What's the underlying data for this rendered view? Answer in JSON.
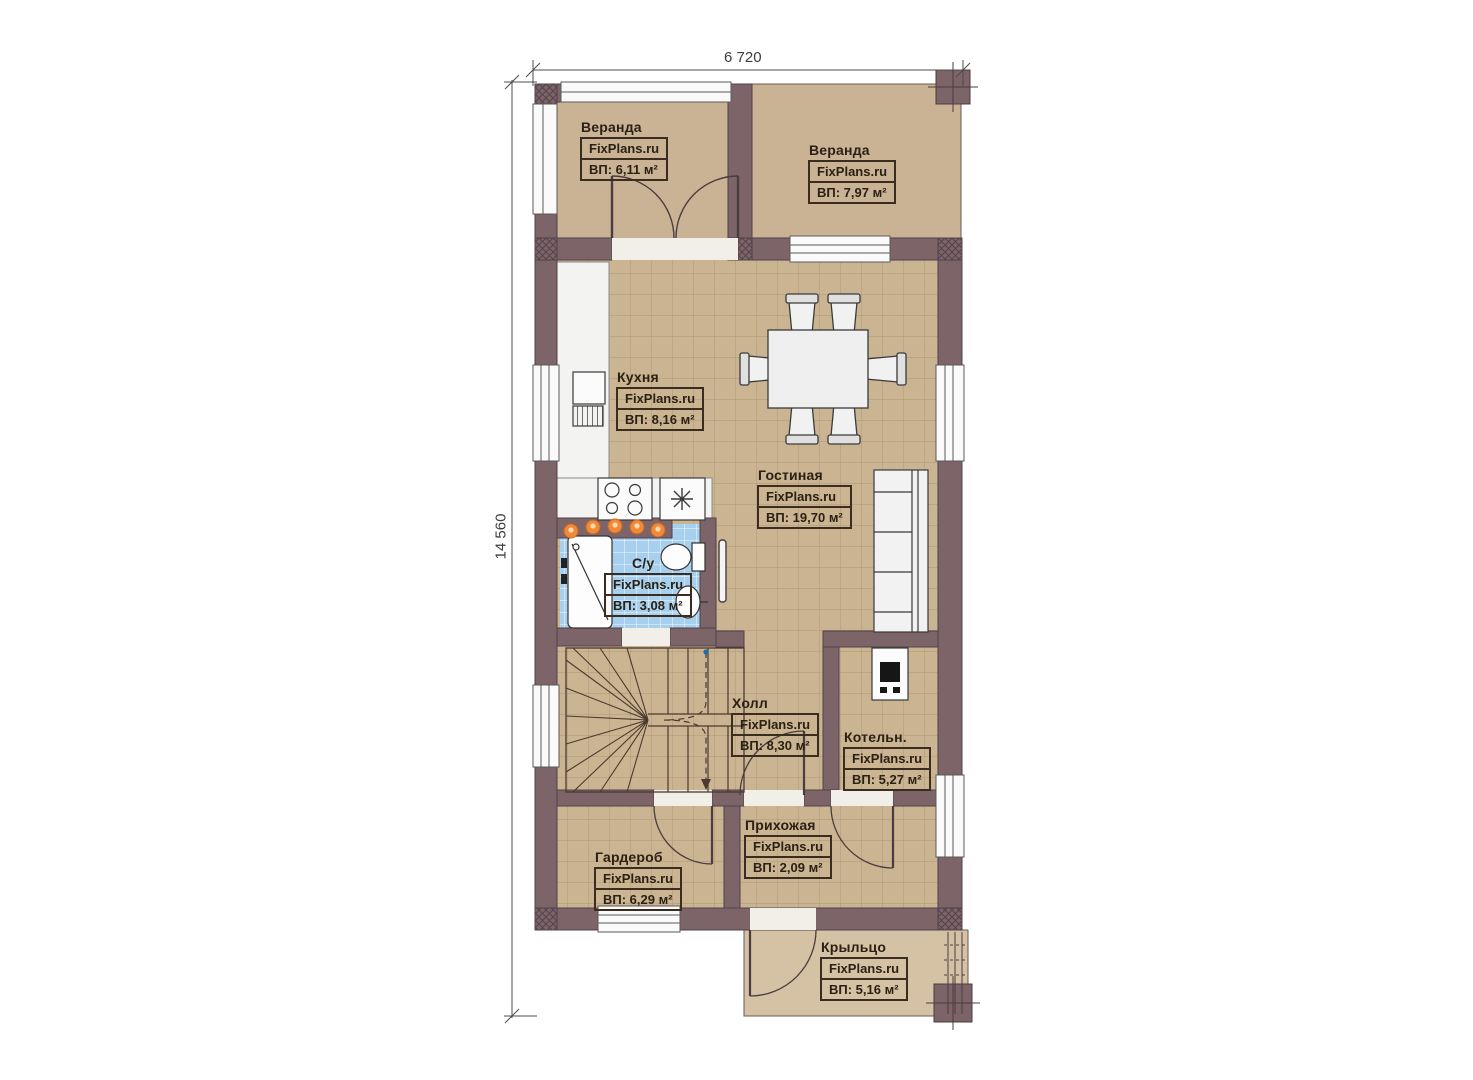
{
  "dimensions": {
    "width_label": "6 720",
    "height_label": "14 560"
  },
  "rooms": [
    {
      "key": "veranda-left",
      "name": "Веранда",
      "brand": "FixPlans.ru",
      "area": "ВП: 6,11 м²"
    },
    {
      "key": "veranda-right",
      "name": "Веранда",
      "brand": "FixPlans.ru",
      "area": "ВП: 7,97 м²"
    },
    {
      "key": "kitchen",
      "name": "Кухня",
      "brand": "FixPlans.ru",
      "area": "ВП: 8,16 м²"
    },
    {
      "key": "living",
      "name": "Гостиная",
      "brand": "FixPlans.ru",
      "area": "ВП: 19,70 м²"
    },
    {
      "key": "bathroom",
      "name": "С/у",
      "brand": "FixPlans.ru",
      "area": "ВП: 3,08 м²"
    },
    {
      "key": "hall",
      "name": "Холл",
      "brand": "FixPlans.ru",
      "area": "ВП: 8,30 м²"
    },
    {
      "key": "boiler",
      "name": "Котельн.",
      "brand": "FixPlans.ru",
      "area": "ВП: 5,27 м²"
    },
    {
      "key": "entry",
      "name": "Прихожая",
      "brand": "FixPlans.ru",
      "area": "ВП: 2,09 м²"
    },
    {
      "key": "wardrobe",
      "name": "Гардероб",
      "brand": "FixPlans.ru",
      "area": "ВП: 6,29 м²"
    },
    {
      "key": "porch",
      "name": "Крыльцо",
      "brand": "FixPlans.ru",
      "area": "ВП: 5,16 м²"
    }
  ],
  "colors": {
    "wall": "#7d6468",
    "floor_tile": "#cbb491",
    "veranda_floor": "#c9b394",
    "porch_floor": "#d5c2a4",
    "bathroom_tile": "#a7d0ee",
    "accent_light": "#e67f2a",
    "label_ink": "#2b2014"
  }
}
